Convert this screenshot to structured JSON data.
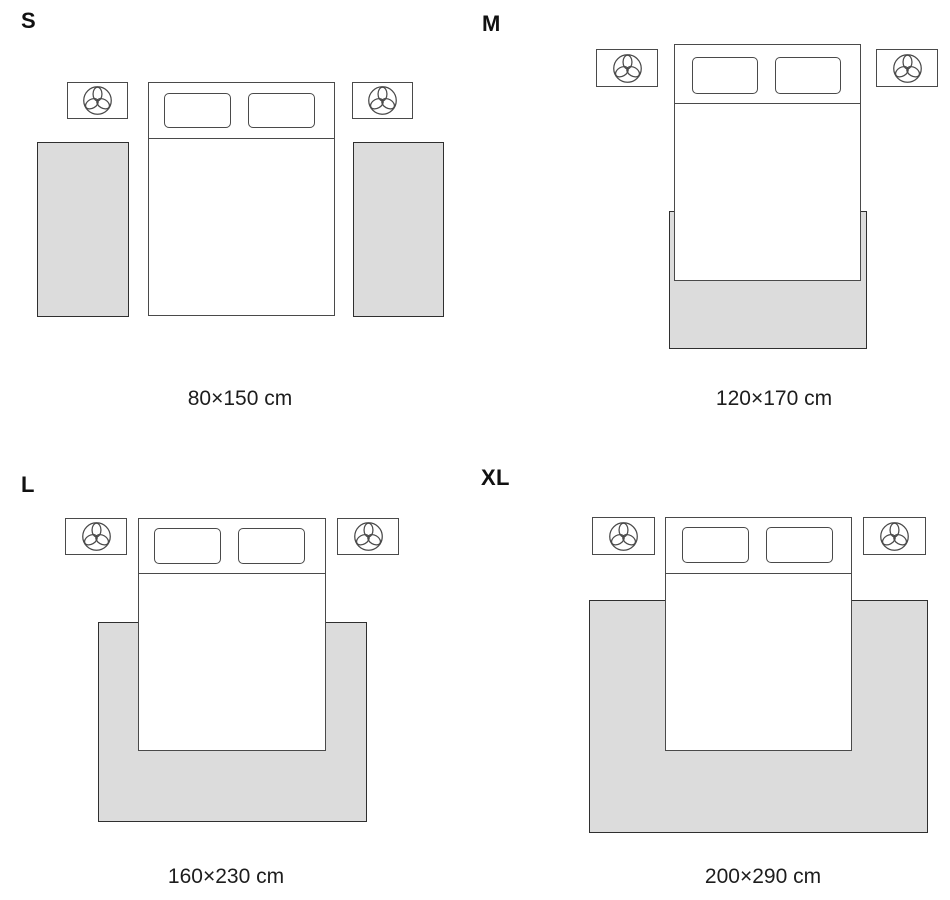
{
  "diagram": {
    "type": "rug-size-guide",
    "background": "#ffffff",
    "rug_fill": "#dcdcdc",
    "rug_border": "#2f2f2f",
    "furniture_line": "#4a4a4a",
    "text_color": "#1d1d1d"
  },
  "icons": {
    "nightstand": "plant-top-view-icon"
  },
  "sizes": [
    {
      "label": "S",
      "caption": "80×150 cm",
      "rug_placement": "two runner rugs beside bed"
    },
    {
      "label": "M",
      "caption": "120×170 cm",
      "rug_placement": "rug under foot of bed"
    },
    {
      "label": "L",
      "caption": "160×230 cm",
      "rug_placement": "rug under lower part of bed"
    },
    {
      "label": "XL",
      "caption": "200×290 cm",
      "rug_placement": "wide rug under bed"
    }
  ]
}
